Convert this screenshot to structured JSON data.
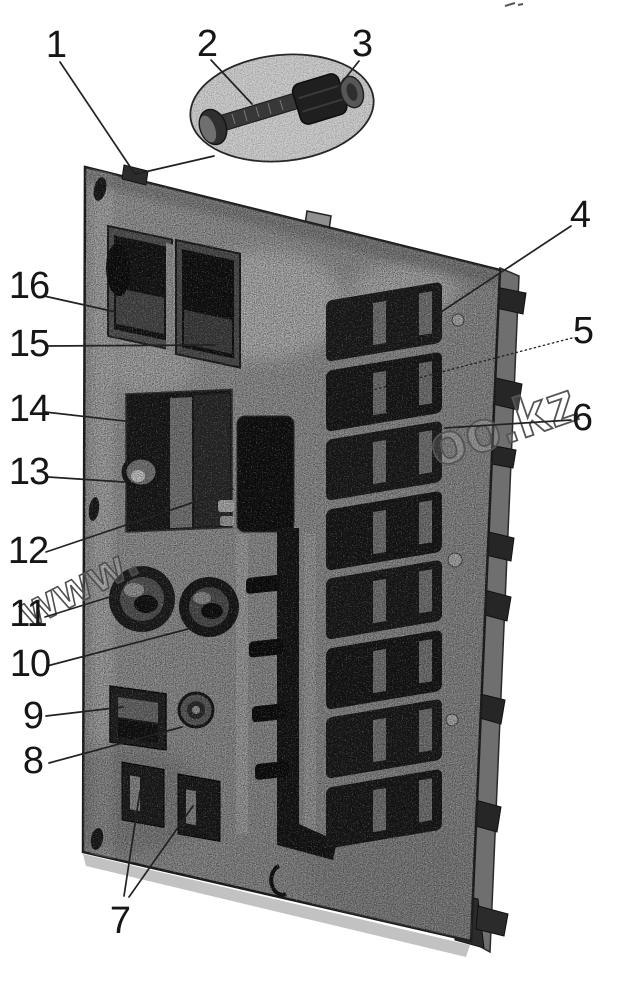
{
  "figure": {
    "kind": "scanned-parts-diagram",
    "subject": "Switch panel assembly (rear view) with fastener detail inset",
    "background_color": "#ffffff",
    "ink_color": "#1c1c1c",
    "panel_gray": "#8f8f8f",
    "recess_dark": "#151515"
  },
  "watermark": {
    "style": "outlined-diagonal",
    "fragments": [
      "www.",
      "oo.kz"
    ]
  },
  "detail_bubble": {
    "contents": [
      "bolt",
      "nut"
    ]
  },
  "callouts": [
    {
      "number": "1",
      "points_to": "clamp on panel top edge"
    },
    {
      "number": "2",
      "points_to": "bolt in detail inset"
    },
    {
      "number": "3",
      "points_to": "nut in detail inset"
    },
    {
      "number": "4",
      "points_to": "top switch of right bank"
    },
    {
      "number": "5",
      "points_to": "second switch of right bank"
    },
    {
      "number": "6",
      "points_to": "third switch of right bank"
    },
    {
      "number": "7",
      "points_to": "two lower rocker switches"
    },
    {
      "number": "8",
      "points_to": "round socket"
    },
    {
      "number": "9",
      "points_to": "lower left switch"
    },
    {
      "number": "10",
      "points_to": "right control knob"
    },
    {
      "number": "11",
      "points_to": "left control knob"
    },
    {
      "number": "12",
      "points_to": "center block"
    },
    {
      "number": "13",
      "points_to": "small knob in left opening"
    },
    {
      "number": "14",
      "points_to": "left panel opening"
    },
    {
      "number": "15",
      "points_to": "upper right rocker switch"
    },
    {
      "number": "16",
      "points_to": "upper left rocker switch"
    }
  ]
}
